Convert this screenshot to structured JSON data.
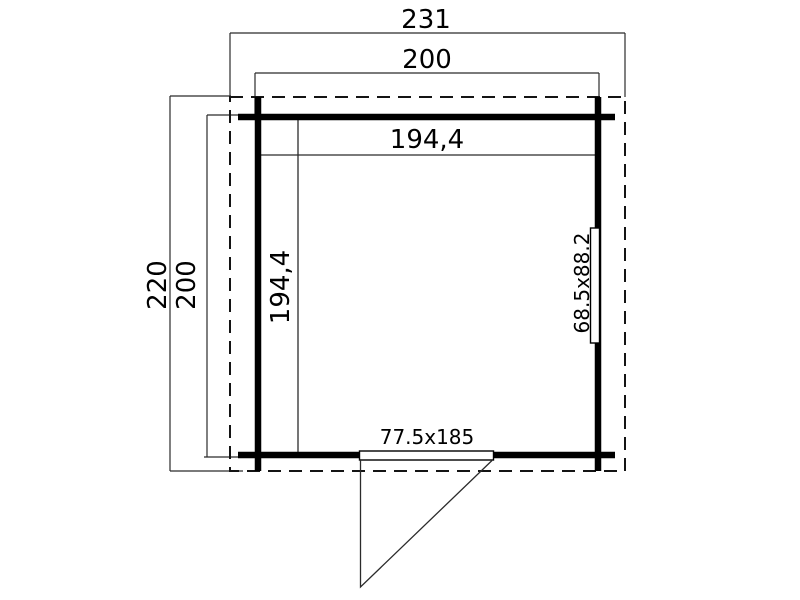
{
  "drawing": {
    "kind": "floor-plan",
    "labels": {
      "total_width": "231",
      "wall_width": "200",
      "inner_width": "194,4",
      "total_depth": "220",
      "wall_depth": "200",
      "inner_depth": "194,4",
      "window_size": "68.5x88.2",
      "door_size": "77.5x185"
    },
    "colors": {
      "background": "#ffffff",
      "wall_line": "#000000",
      "thin_line": "#2b2b2b",
      "dashed_outline": "#141414"
    }
  }
}
